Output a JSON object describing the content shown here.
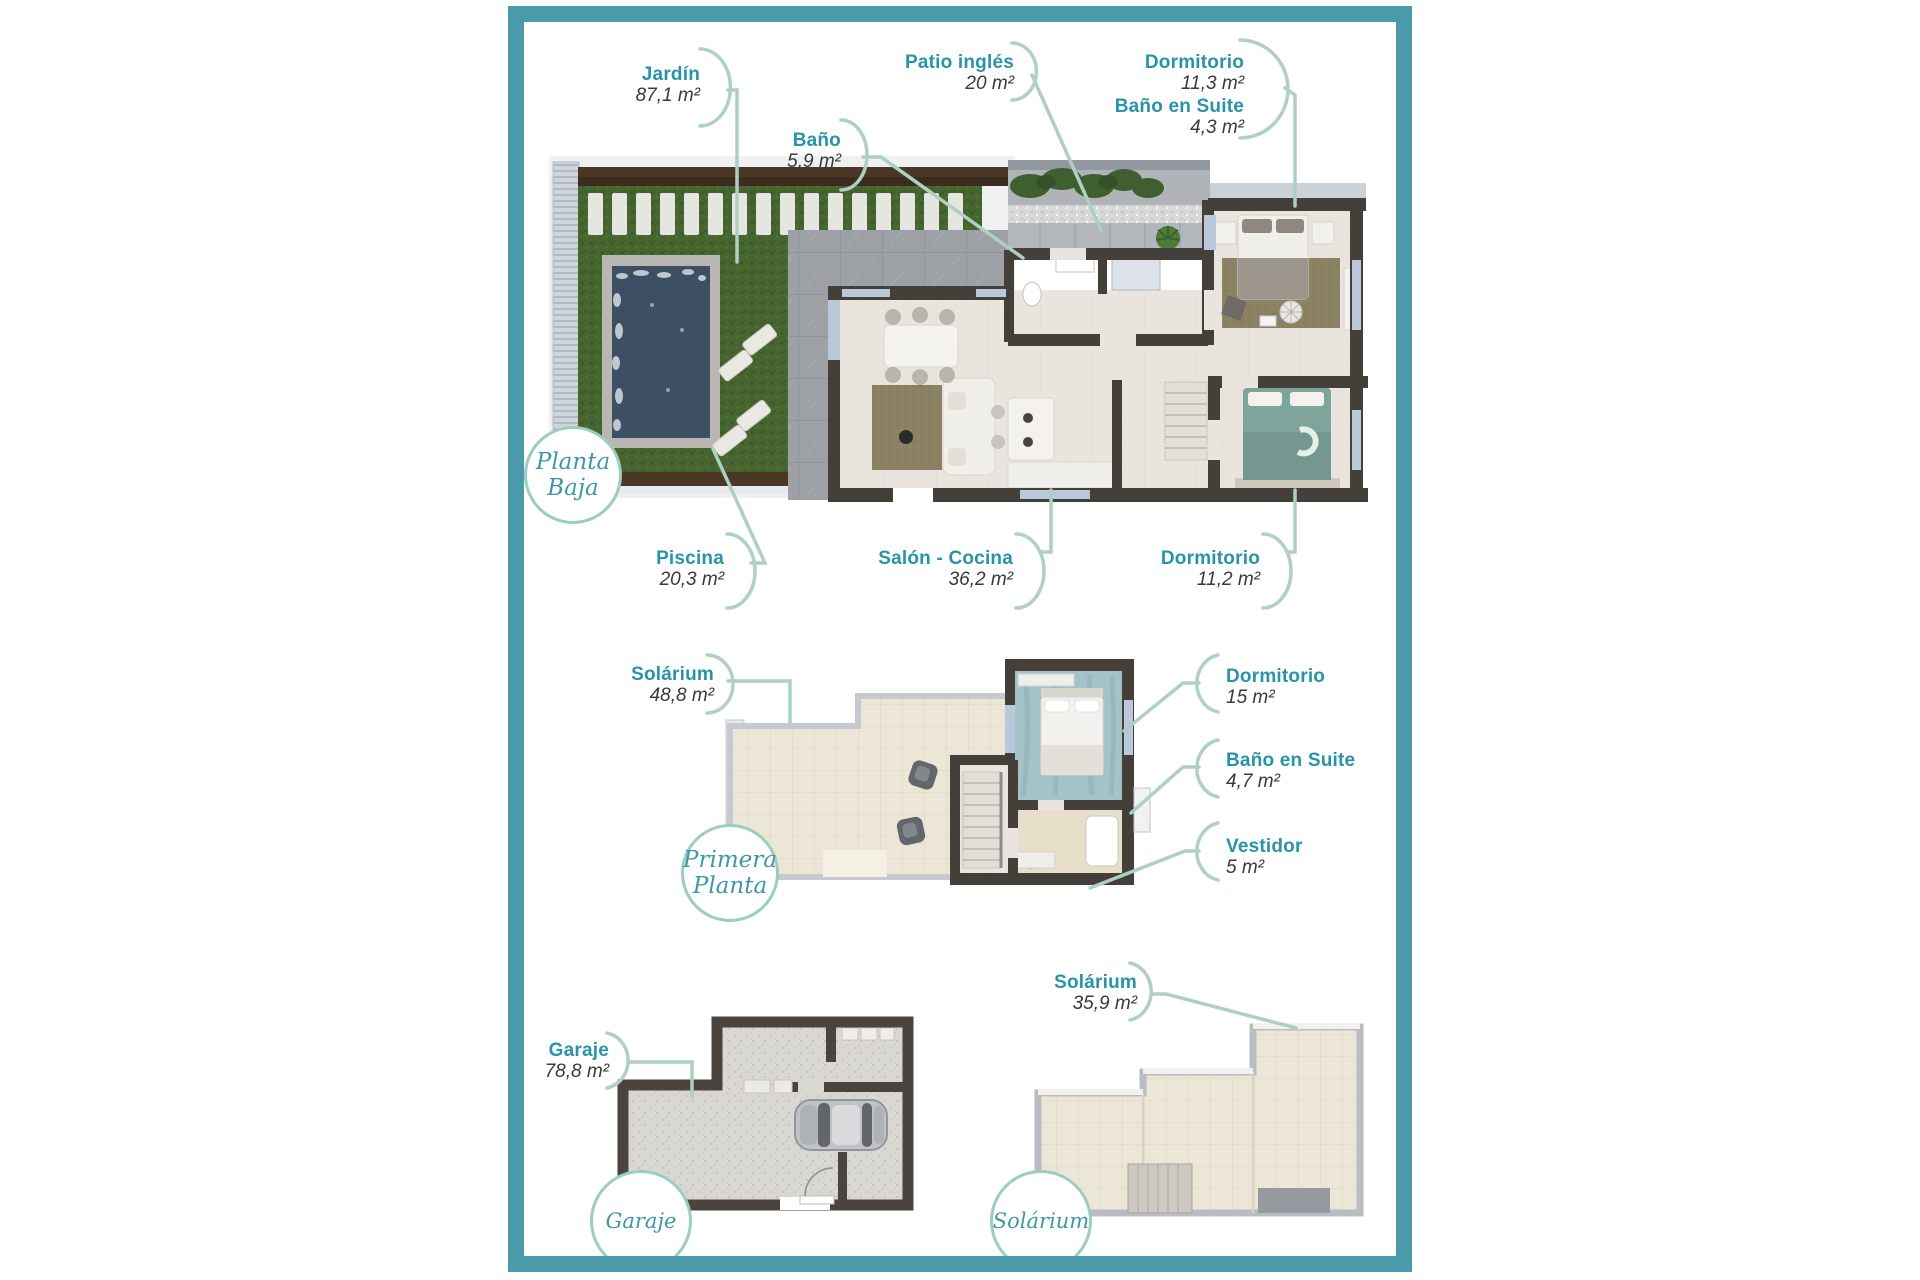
{
  "page": {
    "background": "#ffffff"
  },
  "palette": {
    "frame_teal": "#4a9aab",
    "room_name_teal": "#2993a9",
    "room_area_gray": "#3a3a3a",
    "connector_sage": "#aed0c3",
    "badge_border": "#9ccdc0",
    "badge_text": "#3e98a4",
    "grass_green": "#47652e",
    "pool_blue": "#3d4f63",
    "wall_dark": "#453f39",
    "floor_light": "#e9e5de",
    "tile_cream": "#ece6d6"
  },
  "floors": [
    {
      "id": "planta-baja",
      "circle_lines": [
        "Planta",
        "Baja"
      ],
      "rooms": [
        {
          "id": "jardin",
          "name": "Jardín",
          "area": "87,1 m²"
        },
        {
          "id": "bano",
          "name": "Baño",
          "area": "5,9 m²"
        },
        {
          "id": "patio-ingles",
          "name": "Patio inglés",
          "area": "20 m²"
        },
        {
          "id": "dormitorio-1",
          "name": "Dormitorio",
          "area": "11,3 m²"
        },
        {
          "id": "bano-suite-1",
          "name": "Baño en Suite",
          "area": "4,3 m²"
        },
        {
          "id": "piscina",
          "name": "Piscina",
          "area": "20,3 m²"
        },
        {
          "id": "salon-cocina",
          "name": "Salón - Cocina",
          "area": "36,2 m²"
        },
        {
          "id": "dormitorio-2",
          "name": "Dormitorio",
          "area": "11,2 m²"
        }
      ]
    },
    {
      "id": "primera-planta",
      "circle_lines": [
        "Primera",
        "Planta"
      ],
      "rooms": [
        {
          "id": "solarium-1",
          "name": "Solárium",
          "area": "48,8 m²"
        },
        {
          "id": "dormitorio-3",
          "name": "Dormitorio",
          "area": "15 m²"
        },
        {
          "id": "bano-suite-2",
          "name": "Baño en Suite",
          "area": "4,7 m²"
        },
        {
          "id": "vestidor",
          "name": "Vestidor",
          "area": "5 m²"
        }
      ]
    },
    {
      "id": "garaje",
      "circle_lines": [
        "Garaje"
      ],
      "rooms": [
        {
          "id": "garaje-room",
          "name": "Garaje",
          "area": "78,8 m²"
        }
      ]
    },
    {
      "id": "solarium",
      "circle_lines": [
        "Solárium"
      ],
      "rooms": [
        {
          "id": "solarium-2",
          "name": "Solárium",
          "area": "35,9 m²"
        }
      ]
    }
  ]
}
